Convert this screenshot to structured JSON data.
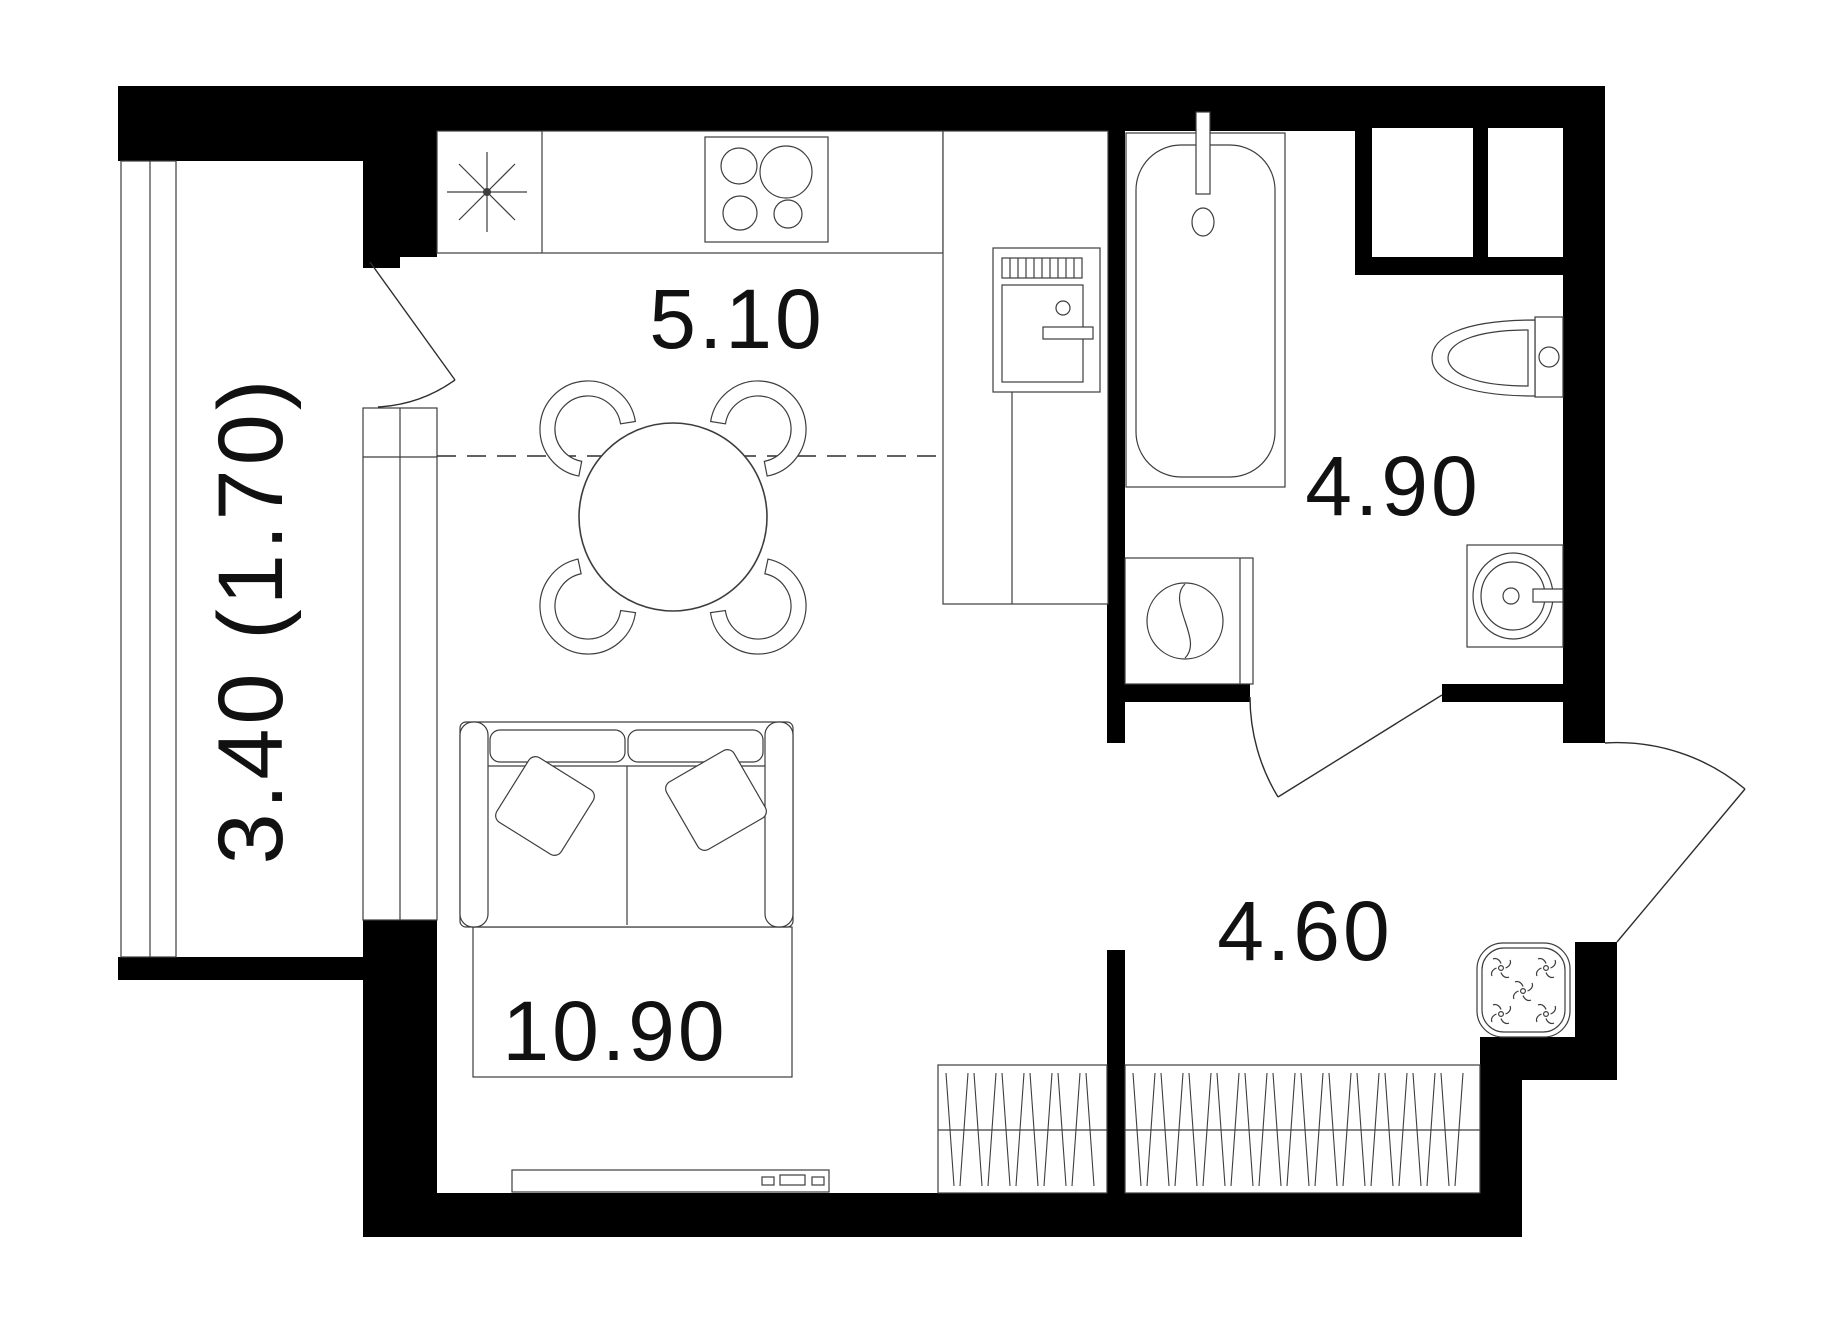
{
  "plan": {
    "type": "apartment-floor-plan",
    "background": "#ffffff",
    "wall_color": "#000000",
    "line_color": "#3d3d3d",
    "label_color": "#111111",
    "rooms": [
      {
        "name": "kitchen-zone",
        "area_label": "5.10"
      },
      {
        "name": "bathroom",
        "area_label": "4.90"
      },
      {
        "name": "hallway",
        "area_label": "4.60"
      },
      {
        "name": "living-zone",
        "area_label": "10.90"
      },
      {
        "name": "balcony",
        "area_label": "3.40 (1.70)"
      }
    ],
    "fixtures": [
      "kitchen-sink",
      "stove-4-burners",
      "refrigerator",
      "dining-table-4-chairs",
      "sofa-2-pillows",
      "rug",
      "tv-console",
      "wardrobe-living",
      "wardrobe-hall",
      "bathtub",
      "toilet",
      "washing-machine",
      "bathroom-sink",
      "pouf",
      "balcony-door",
      "bathroom-door",
      "entrance-door"
    ]
  }
}
